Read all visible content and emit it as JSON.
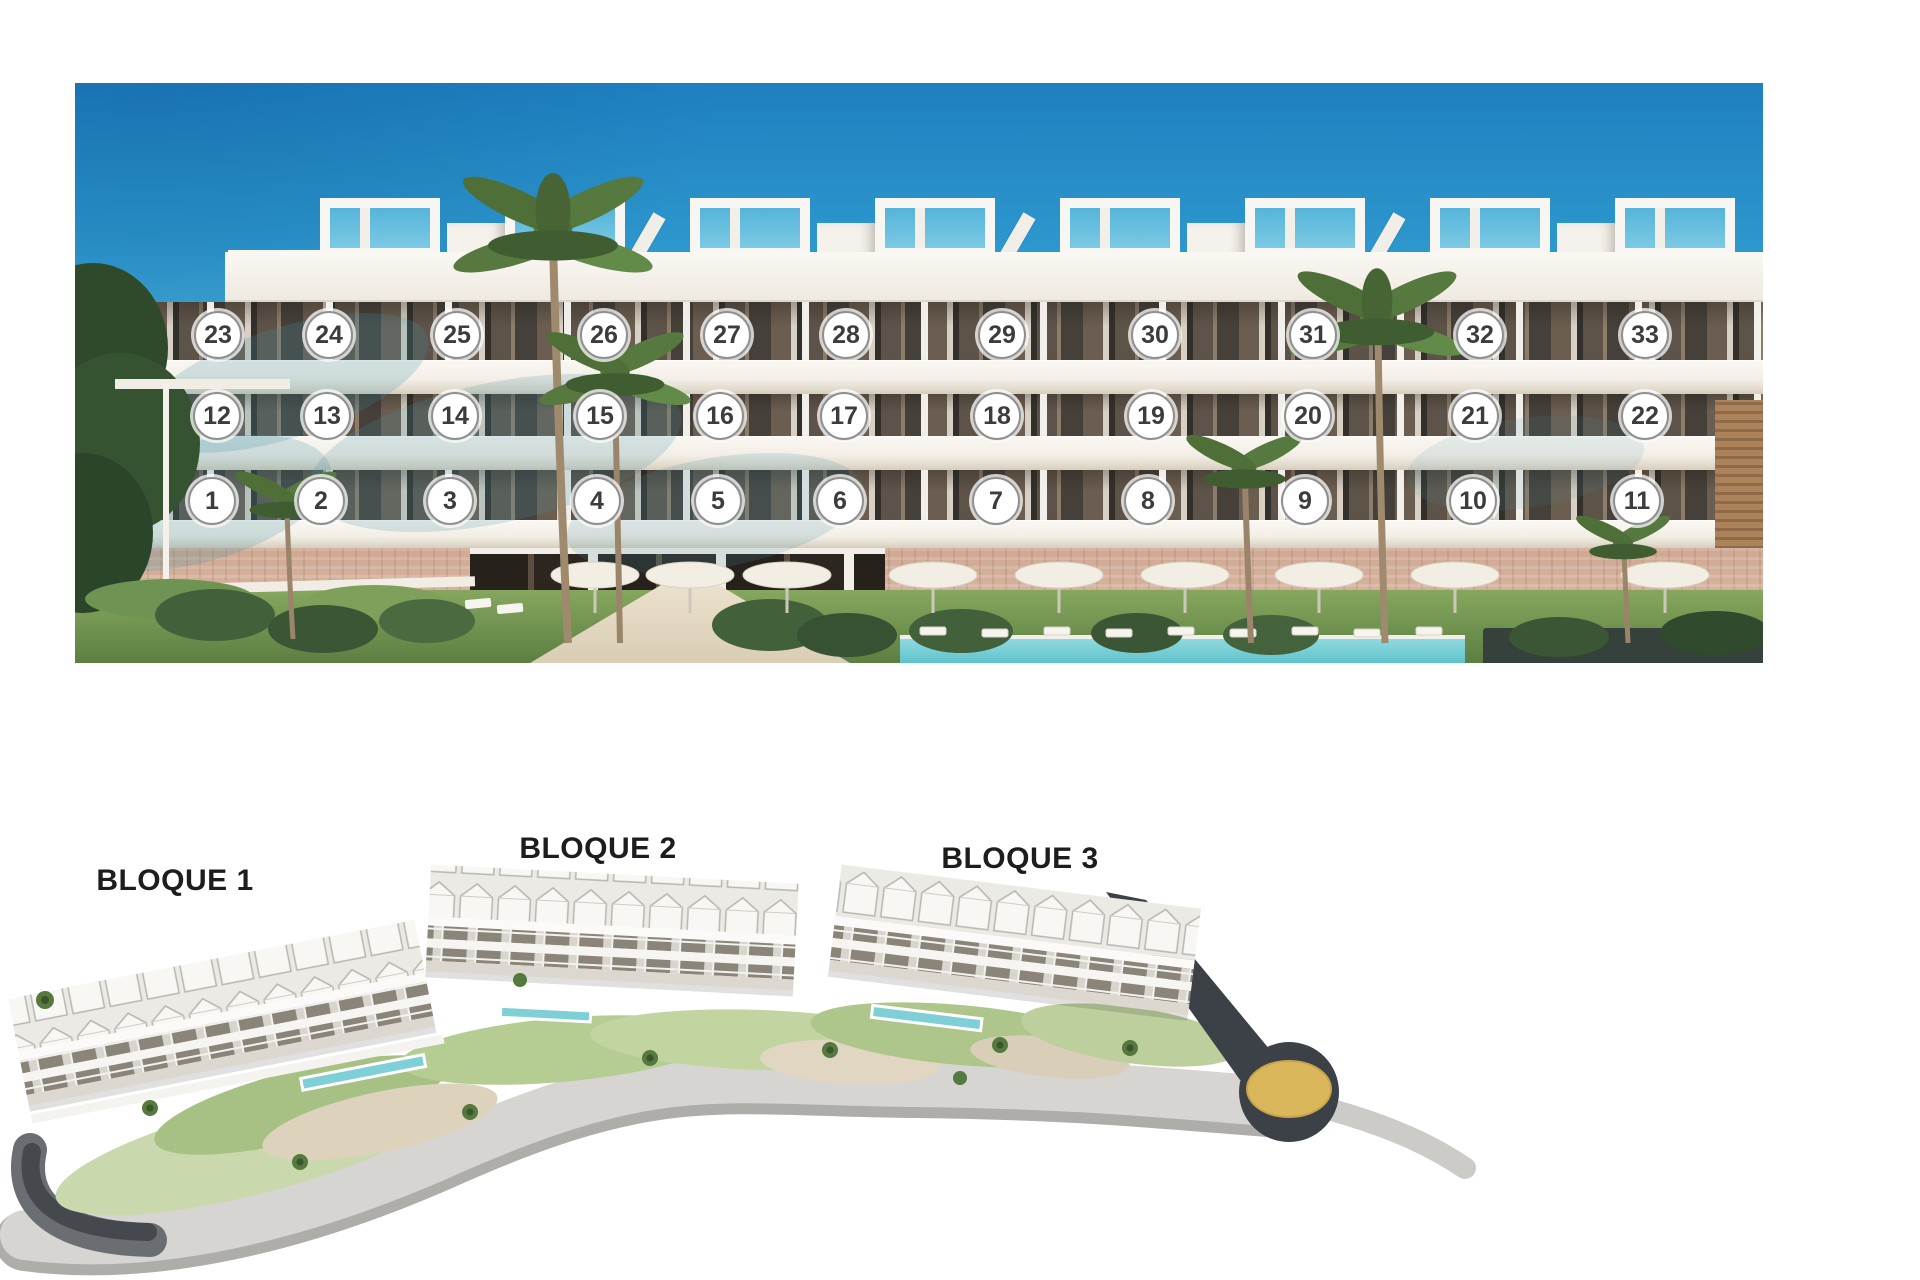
{
  "meta": {
    "description": "New-build residence promotional sheet: numbered front elevation above, aerial site plan with three blocks below"
  },
  "elevation": {
    "badge": {
      "diameter": 48,
      "fill": "#ffffff",
      "border_color": "#8f8f8f",
      "text_color": "#3c3c3c"
    },
    "rows": [
      {
        "level": "third-floor",
        "y": 335,
        "units": [
          {
            "n": "23",
            "x": 218
          },
          {
            "n": "24",
            "x": 329
          },
          {
            "n": "25",
            "x": 457
          },
          {
            "n": "26",
            "x": 604
          },
          {
            "n": "27",
            "x": 727
          },
          {
            "n": "28",
            "x": 846
          },
          {
            "n": "29",
            "x": 1002
          },
          {
            "n": "30",
            "x": 1155
          },
          {
            "n": "31",
            "x": 1313
          },
          {
            "n": "32",
            "x": 1480
          },
          {
            "n": "33",
            "x": 1645
          }
        ]
      },
      {
        "level": "second-floor",
        "y": 416,
        "units": [
          {
            "n": "12",
            "x": 217
          },
          {
            "n": "13",
            "x": 327
          },
          {
            "n": "14",
            "x": 455
          },
          {
            "n": "15",
            "x": 600
          },
          {
            "n": "16",
            "x": 720
          },
          {
            "n": "17",
            "x": 844
          },
          {
            "n": "18",
            "x": 997
          },
          {
            "n": "19",
            "x": 1151
          },
          {
            "n": "20",
            "x": 1308
          },
          {
            "n": "21",
            "x": 1475
          },
          {
            "n": "22",
            "x": 1645
          }
        ]
      },
      {
        "level": "first-floor",
        "y": 501,
        "units": [
          {
            "n": "1",
            "x": 212
          },
          {
            "n": "2",
            "x": 321
          },
          {
            "n": "3",
            "x": 450
          },
          {
            "n": "4",
            "x": 597
          },
          {
            "n": "5",
            "x": 718
          },
          {
            "n": "6",
            "x": 840
          },
          {
            "n": "7",
            "x": 996
          },
          {
            "n": "8",
            "x": 1148
          },
          {
            "n": "9",
            "x": 1305
          },
          {
            "n": "10",
            "x": 1473
          },
          {
            "n": "11",
            "x": 1637
          }
        ]
      }
    ],
    "palette": {
      "sky_top": "#1f7fc0",
      "sky_horizon": "#c8e9f2",
      "facade": "#f5f2ec",
      "glazing": "#5e5348",
      "base_wall": "#d8b7a3",
      "pool": "#79ccd4",
      "lawn": "#6f9352"
    }
  },
  "site_plan": {
    "blocks": [
      {
        "label": "BLOQUE 1",
        "x": 175,
        "y": 864
      },
      {
        "label": "BLOQUE 2",
        "x": 598,
        "y": 832
      },
      {
        "label": "BLOQUE 3",
        "x": 1020,
        "y": 842
      }
    ],
    "label_color": "#1d1d1b",
    "road_color": "#3c4147",
    "roundabout_center_color": "#d9b75a"
  }
}
